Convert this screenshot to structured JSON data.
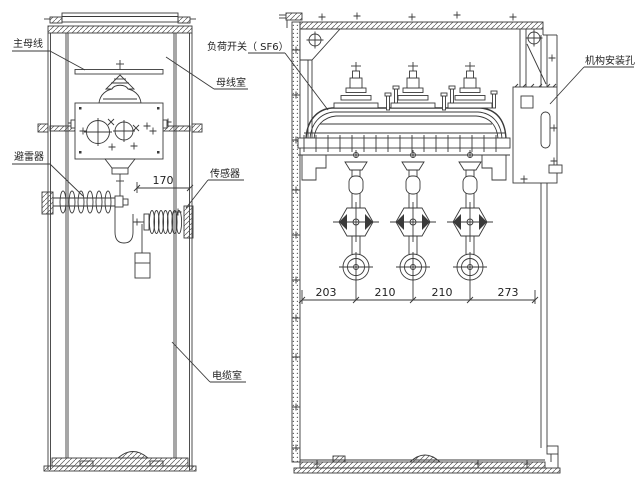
{
  "diagram": {
    "labels": {
      "main_busbar": "主母线",
      "load_switch": "负荷开关（ SF6）",
      "busbar_compartment": "母线室",
      "surge_arrester": "避雷器",
      "sensor": "传感器",
      "cable_compartment": "电缆室",
      "mechanism_mounting_hole": "机构安装孔"
    },
    "dimensions": {
      "sensor_offset": "170",
      "phase_spacings": [
        "203",
        "210",
        "210",
        "273"
      ]
    },
    "colors": {
      "line": "#3a3a3a",
      "background": "#ffffff"
    }
  }
}
